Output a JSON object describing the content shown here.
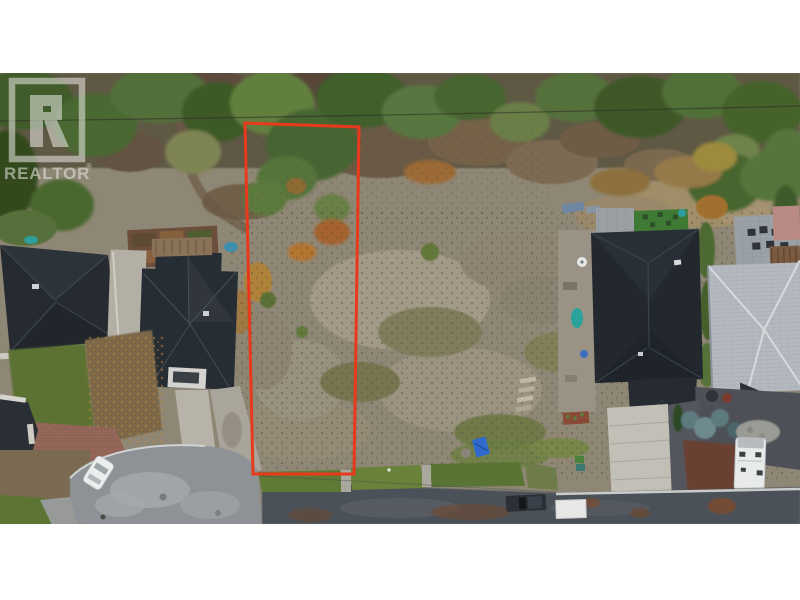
{
  "photo": {
    "kind": "aerial-drone-photo",
    "subject": "vacant residential lot outlined in red between houses",
    "letterbox_color": "#ffffff",
    "boundary_color": "#e8391d",
    "road_color": "#4c5158",
    "culdesac_color": "#8e9296",
    "roof_dark_color": "#23282f",
    "roof_light_color": "#b4b9bf"
  },
  "watermark": {
    "brand": "REALTOR",
    "registered": "®",
    "logo": "realtor-block-r-logo"
  }
}
